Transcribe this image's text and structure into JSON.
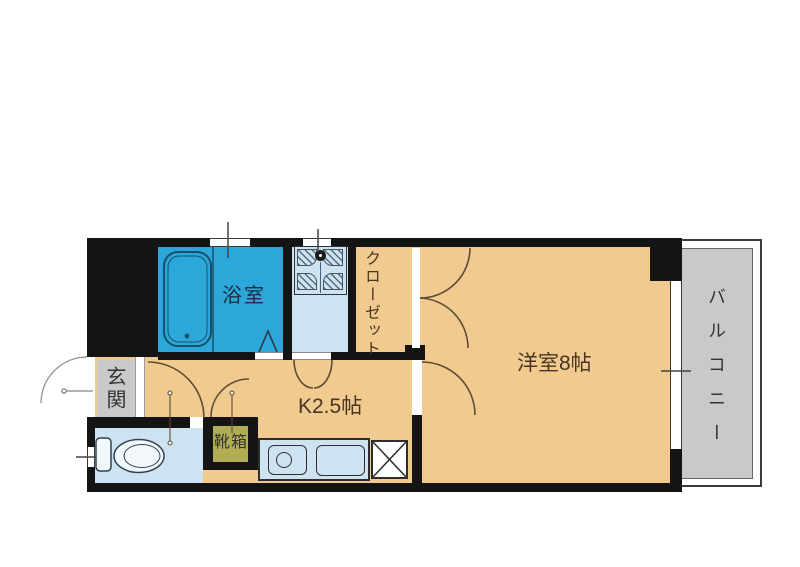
{
  "plan": {
    "rooms": {
      "bathroom": "浴室",
      "closet": "クローゼット",
      "western_room": "洋室8帖",
      "balcony": "バルコニー",
      "entrance": "玄関",
      "shoe_box": "靴箱",
      "kitchen": "K2.5帖"
    },
    "colors": {
      "wall": "#141414",
      "room_tan": "#f0ca8e",
      "bathroom_blue": "#2ba7d9",
      "water_area_blue": "#cde3f1",
      "balcony_gray": "#c9c9c9",
      "shoe_box_olive": "#b1ad55",
      "door_arc_brown": "#5f4b33",
      "label_brown": "#4a3522"
    }
  }
}
